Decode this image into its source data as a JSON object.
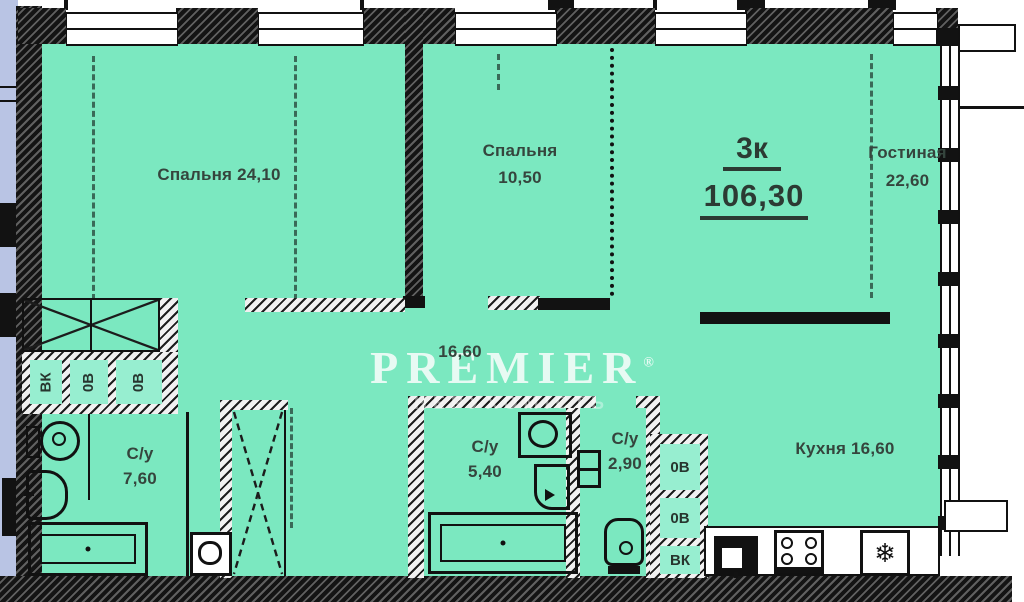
{
  "plan": {
    "title": {
      "type": "3к",
      "area": "106,30"
    },
    "bedroom1": {
      "label": "Спальня 24,10"
    },
    "bedroom2": {
      "name": "Спальня",
      "area": "10,50"
    },
    "living": {
      "name": "Гостиная",
      "area": "22,60"
    },
    "hall": {
      "area": "16,60"
    },
    "bath1": {
      "name": "С/у",
      "area": "7,60"
    },
    "bath2": {
      "name": "С/у",
      "area": "5,40"
    },
    "bath3": {
      "name": "С/у",
      "area": "2,90"
    },
    "kitchen": {
      "label": "Кухня 16,60"
    },
    "shafts_left": [
      "ВК",
      "0В",
      "0В"
    ],
    "shafts_right": [
      "0В",
      "0В",
      "ВК"
    ],
    "watermark": {
      "brand": "PREMIER",
      "reg": "®",
      "subtitle": "НЕРУХОМІСТЬ"
    },
    "icons": {
      "freezer": "❄"
    },
    "colors": {
      "room_fill": "#7be8c0",
      "outside_strip": "#b9c4e4",
      "wall": "#141414",
      "label_text": "#35453d",
      "watermark_text": "#ffffff"
    }
  }
}
